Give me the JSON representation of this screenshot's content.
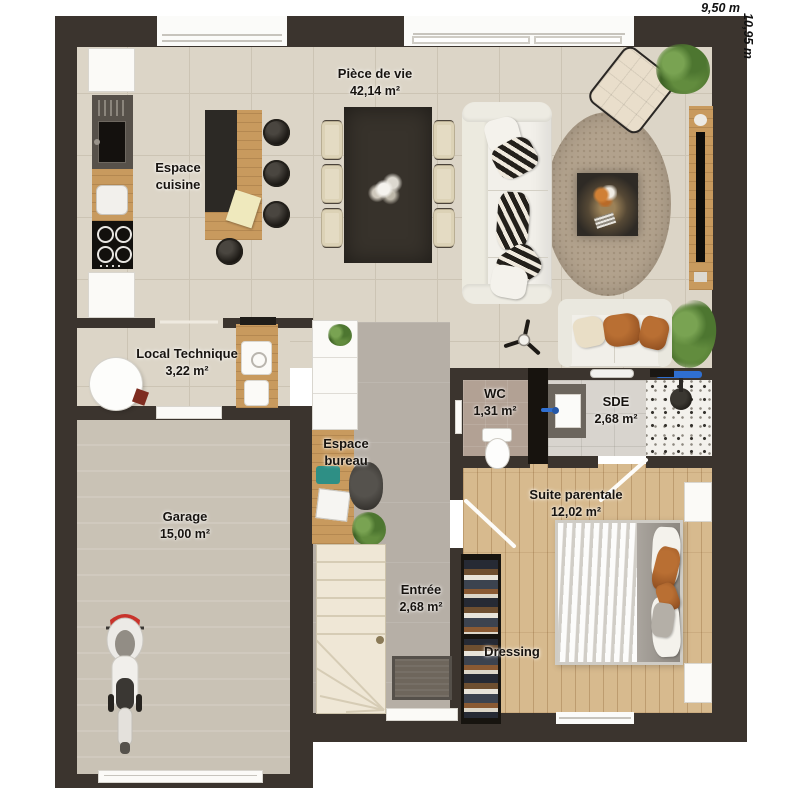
{
  "plan": {
    "type_label": "floor-plan",
    "dimensions": {
      "width": "9,50 m",
      "height": "10,95 m"
    },
    "rooms": [
      {
        "id": "piece-de-vie",
        "name": "Pièce de vie",
        "area": "42,14 m²"
      },
      {
        "id": "espace-cuisine",
        "name": "Espace cuisine"
      },
      {
        "id": "local-technique",
        "name": "Local Technique",
        "area": "3,22 m²"
      },
      {
        "id": "wc",
        "name": "WC",
        "area": "1,31 m²"
      },
      {
        "id": "sde",
        "name": "SDE",
        "area": "2,68 m²"
      },
      {
        "id": "suite-parentale",
        "name": "Suite parentale",
        "area": "12,02 m²"
      },
      {
        "id": "espace-bureau",
        "name": "Espace bureau"
      },
      {
        "id": "garage",
        "name": "Garage",
        "area": "15,00 m²"
      },
      {
        "id": "entree",
        "name": "Entrée",
        "area": "2,68 m²"
      },
      {
        "id": "dressing",
        "name": "Dressing"
      }
    ],
    "colors": {
      "wall": "#3b342e",
      "tile_floor": "#dcd5c7",
      "wood_floor": "#d7ba8e",
      "garage_floor": "#c9c2b5",
      "accent_blue": "#2f6fd0",
      "wood_furniture": "#c89a5e"
    }
  }
}
